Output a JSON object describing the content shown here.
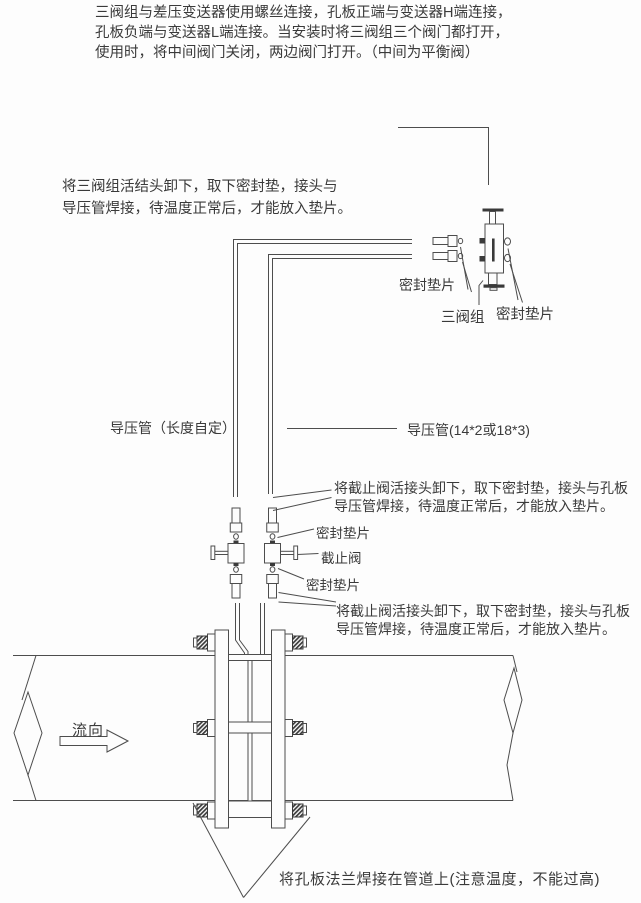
{
  "colors": {
    "background": "#fdfdfd",
    "line": "#4d4d4d",
    "text": "#3a3a3a"
  },
  "notes": {
    "top": "三阀组与差压变送器使用螺丝连接，孔板正端与变送器H端连接，\n孔板负端与变送器L端连接。当安装时将三阀组三个阀门都打开，\n使用时，将中间阀门关闭，两边阀门打开。（中间为平衡阀）",
    "manifold_union": "将三阀组活结头卸下，取下密封垫，接头与\n导压管焊接，待温度正常后，才能放入垫片。",
    "stop_valve_upper": "将截止阀活接头卸下，取下密封垫，接头与孔板\n导压管焊接，待温度正常后，才能放入垫片。",
    "stop_valve_lower": "将截止阀活接头卸下，取下密封垫，接头与孔板\n导压管焊接，待温度正常后，才能放入垫片。",
    "flange_weld": "将孔板法兰焊接在管道上(注意温度，不能过高)"
  },
  "labels": {
    "gasket_left": "密封垫片",
    "manifold": "三阀组",
    "gasket_right": "密封垫片",
    "impulse_pipe_left": "导压管（长度自定）",
    "impulse_pipe_right": "导压管(14*2或18*3)",
    "gasket_mid_top": "密封垫片",
    "stop_valve": "截止阀",
    "gasket_mid_bottom": "密封垫片",
    "flow_direction": "流向"
  }
}
